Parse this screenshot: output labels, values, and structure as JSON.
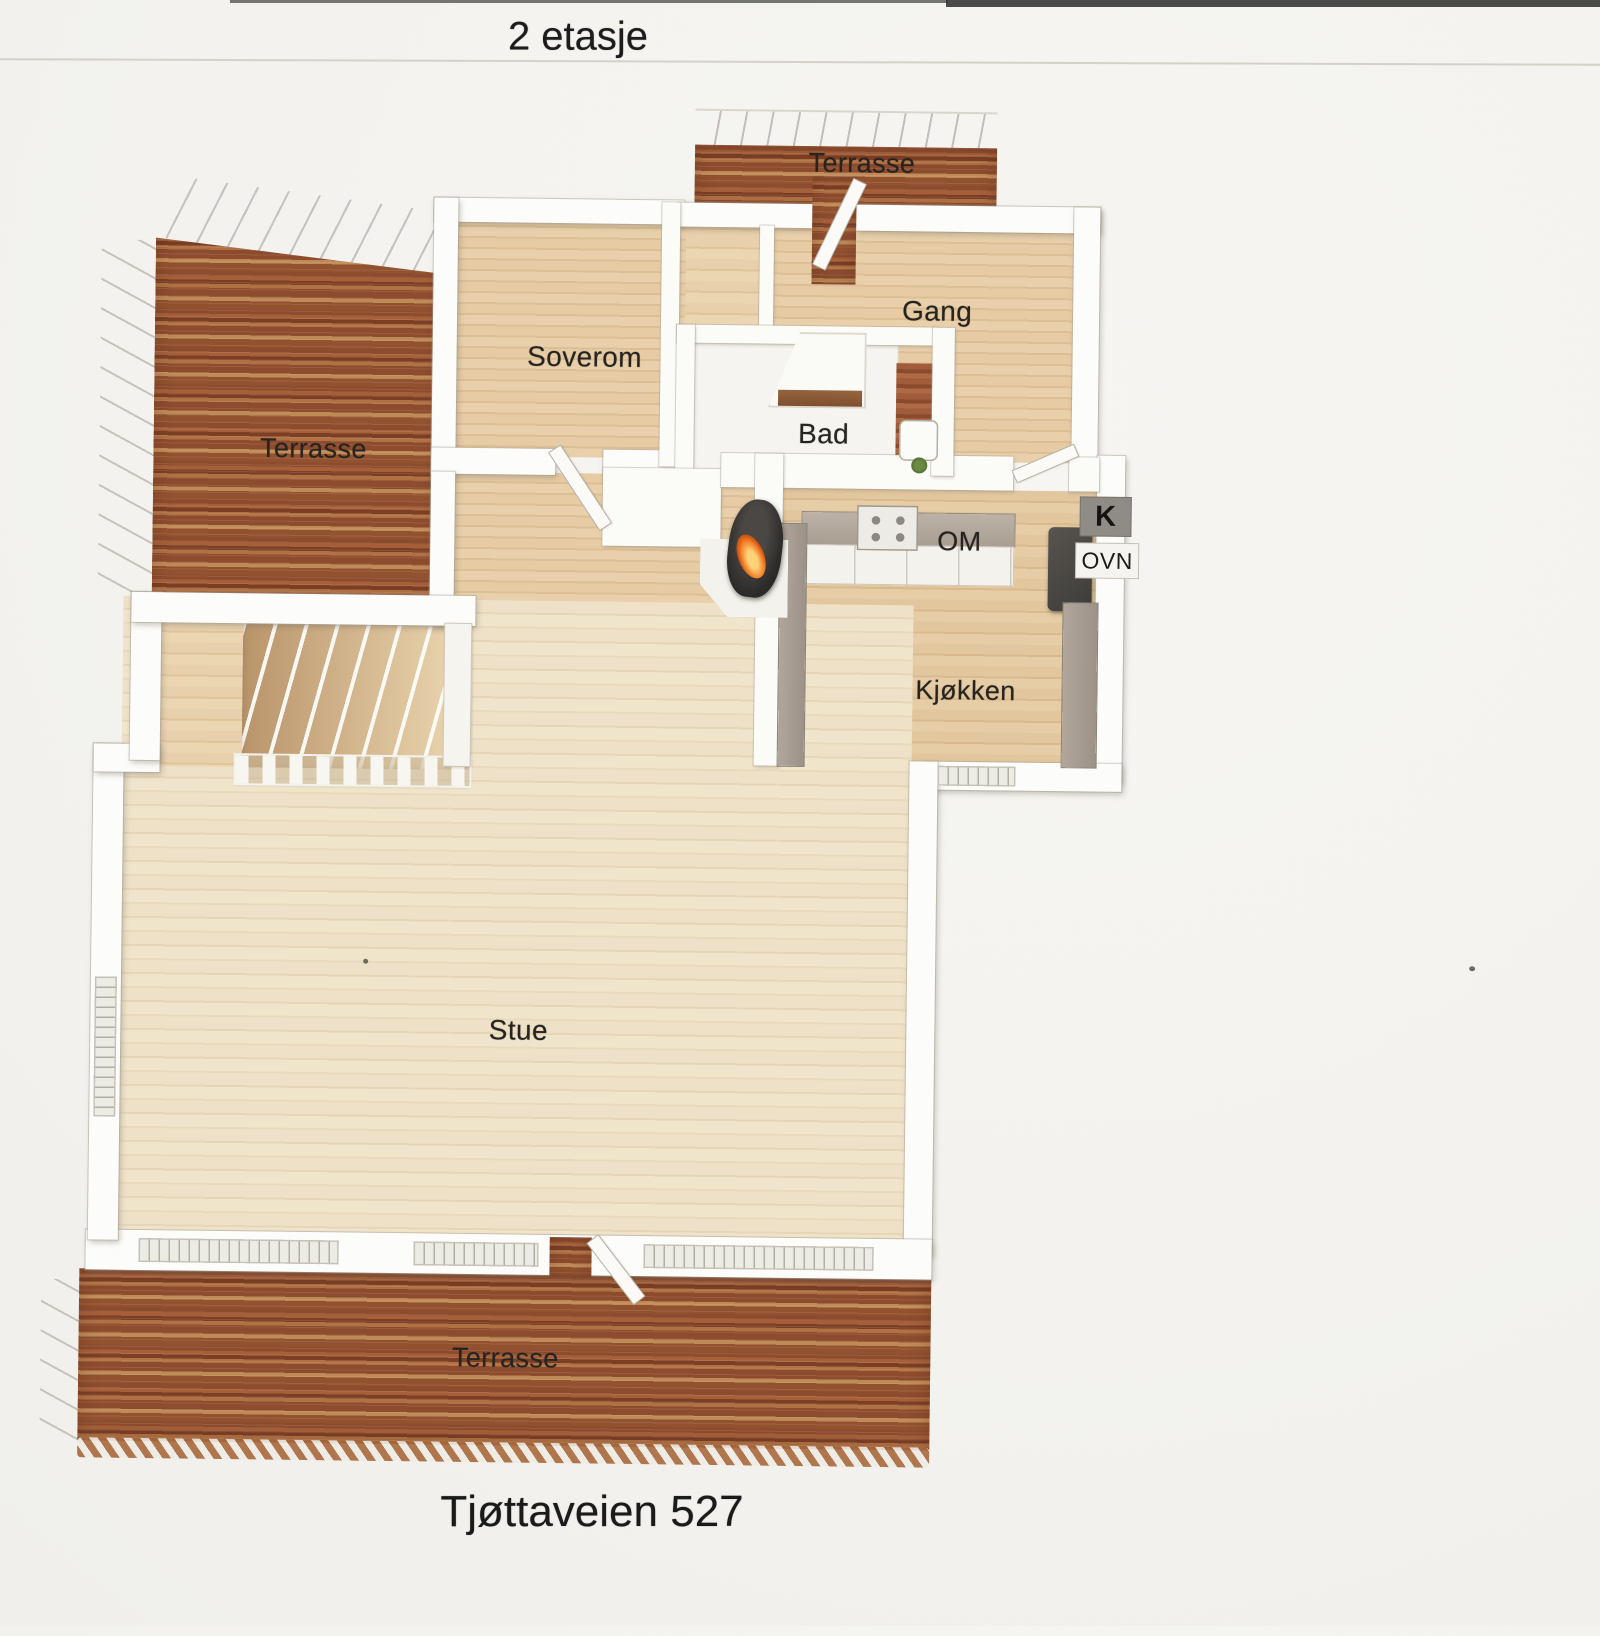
{
  "page": {
    "title": "2 etasje",
    "address": "Tjøttaveien 527"
  },
  "labels": {
    "terrasse_top": "Terrasse",
    "terrasse_left": "Terrasse",
    "terrasse_bottom": "Terrasse",
    "soverom": "Soverom",
    "gang": "Gang",
    "bad": "Bad",
    "om": "OM",
    "k": "K",
    "ovn": "OVN",
    "kjokken": "Kjøkken",
    "stue": "Stue"
  },
  "colors": {
    "page_background": "#f3f2ee",
    "deck_wood": "#9a5636",
    "hall_floor": "#e3c8a1",
    "living_floor": "#ede0c5",
    "wall_white": "#fbfbf9",
    "counter_gray": "#aba195",
    "fridge_dark": "#46443f",
    "flame_orange": "#f07820"
  }
}
